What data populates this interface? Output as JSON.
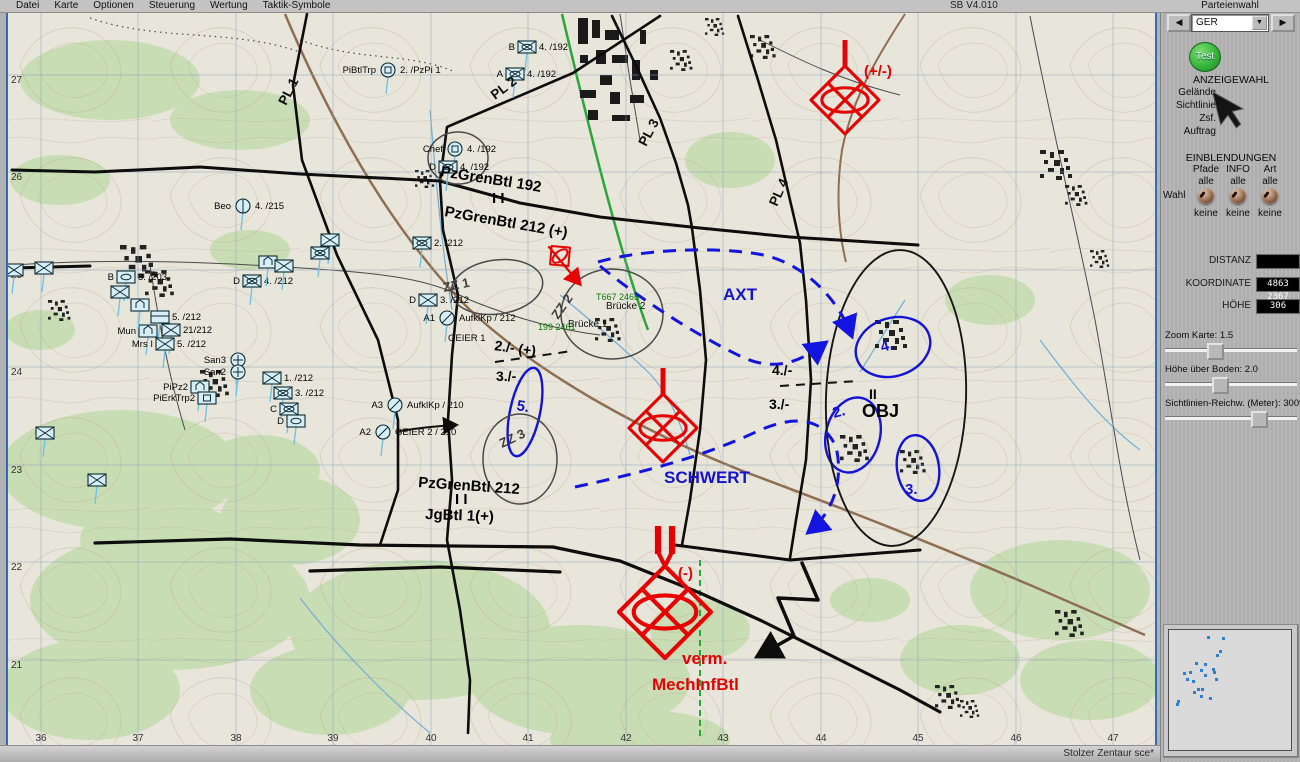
{
  "menu": {
    "items": [
      "Datei",
      "Karte",
      "Optionen",
      "Steuerung",
      "Wertung",
      "Taktik-Symbole"
    ],
    "version": "SB V4.010"
  },
  "panel": {
    "party_label": "Parteienwahl",
    "party_value": "GER",
    "left_arrow": "◀",
    "right_arrow": "▶",
    "dropdown_arrow": "▼",
    "test_button": "Test",
    "anzeigewahl": {
      "title": "ANZEIGEWAHL",
      "items": [
        "Gelände",
        "Sichtlinie",
        "Zsf.",
        "Auftrag"
      ]
    },
    "einblendungen": {
      "title": "EINBLENDUNGEN",
      "wahl_label": "Wahl",
      "columns": [
        {
          "name": "Pfade",
          "top": "alle",
          "bottom": "keine"
        },
        {
          "name": "INFO",
          "top": "alle",
          "bottom": "keine"
        },
        {
          "name": "Art",
          "top": "alle",
          "bottom": "keine"
        }
      ]
    },
    "readouts": [
      {
        "label": "DISTANZ",
        "value": ""
      },
      {
        "label": "KOORDINATE",
        "value": "4863 2367"
      },
      {
        "label": "HÖHE",
        "value": "306"
      }
    ],
    "sliders": [
      {
        "label": "Zoom Karte:  1.5",
        "pos": 36
      },
      {
        "label": "Höhe über Boden:  2.0",
        "pos": 40
      },
      {
        "label": "Sichtlinien-Reichw. (Meter):  3009",
        "pos": 70
      }
    ],
    "minimap_dots": [
      [
        0.32,
        0.05
      ],
      [
        0.44,
        0.06
      ],
      [
        0.42,
        0.17
      ],
      [
        0.39,
        0.2
      ],
      [
        0.22,
        0.27
      ],
      [
        0.29,
        0.28
      ],
      [
        0.36,
        0.32
      ],
      [
        0.26,
        0.33
      ],
      [
        0.17,
        0.35
      ],
      [
        0.12,
        0.36
      ],
      [
        0.37,
        0.35
      ],
      [
        0.29,
        0.37
      ],
      [
        0.14,
        0.41
      ],
      [
        0.19,
        0.42
      ],
      [
        0.38,
        0.41
      ],
      [
        0.23,
        0.49
      ],
      [
        0.27,
        0.49
      ],
      [
        0.2,
        0.52
      ],
      [
        0.26,
        0.55
      ],
      [
        0.33,
        0.57
      ],
      [
        0.07,
        0.59
      ],
      [
        0.06,
        0.62
      ]
    ]
  },
  "statusbar": {
    "text": "Stolzer Zentaur sce*"
  },
  "map": {
    "grid_x": [
      [
        "36",
        41
      ],
      [
        "37",
        138
      ],
      [
        "38",
        236
      ],
      [
        "39",
        333
      ],
      [
        "40",
        431
      ],
      [
        "41",
        528
      ],
      [
        "42",
        626
      ],
      [
        "43",
        723
      ],
      [
        "44",
        821
      ],
      [
        "45",
        918
      ],
      [
        "46",
        1016
      ],
      [
        "47",
        1113
      ]
    ],
    "grid_y": [
      [
        "27",
        79
      ],
      [
        "26",
        176
      ],
      [
        "25",
        274
      ],
      [
        "24",
        371
      ],
      [
        "23",
        469
      ],
      [
        "22",
        566
      ],
      [
        "21",
        664
      ]
    ],
    "labels": [
      [
        "PL 1",
        286,
        106,
        "pl",
        -63
      ],
      [
        "PL 2",
        495,
        100,
        "pl",
        -37
      ],
      [
        "PL 3",
        646,
        147,
        "pl",
        -62
      ],
      [
        "PL 4",
        777,
        207,
        "pl",
        -66
      ],
      [
        "PzGrenBtl 192",
        440,
        176,
        "bdy",
        9
      ],
      [
        "I I",
        492,
        203,
        "bdy",
        0
      ],
      [
        "PzGrenBtl 212 (+)",
        444,
        216,
        "bdy",
        10
      ],
      [
        "PzGrenBtl 212",
        418,
        487,
        "bdy",
        4
      ],
      [
        "I I",
        455,
        504,
        "bdy",
        0
      ],
      [
        "JgBtl 1(+)",
        425,
        519,
        "bdy",
        2
      ],
      [
        "AXT",
        723,
        300,
        "blue",
        0
      ],
      [
        "SCHWERT",
        664,
        483,
        "blue",
        0
      ],
      [
        "5.",
        516,
        410,
        "bnum",
        10
      ],
      [
        "4.",
        882,
        352,
        "bnum",
        -15
      ],
      [
        "2.",
        834,
        418,
        "bnum",
        -15
      ],
      [
        "3.",
        905,
        494,
        "bnum",
        0
      ],
      [
        "2./- (+)",
        494,
        350,
        "knum",
        8
      ],
      [
        "3./-",
        496,
        381,
        "knum",
        0
      ],
      [
        "4./-",
        772,
        375,
        "knum",
        0
      ],
      [
        "3./-",
        769,
        409,
        "knum",
        0
      ],
      [
        "II",
        869,
        399,
        "knum",
        0
      ],
      [
        "OBJ",
        862,
        417,
        "obj",
        0
      ],
      [
        "ZZ 1",
        444,
        292,
        "zz",
        -12
      ],
      [
        "ZZ 2",
        558,
        320,
        "zz",
        -55
      ],
      [
        "ZZ 3",
        502,
        448,
        "zz",
        -25
      ],
      [
        "(+/-)",
        864,
        76,
        "redl",
        0
      ],
      [
        "(-)",
        678,
        578,
        "redl",
        0
      ],
      [
        "verm.",
        682,
        664,
        "redbig",
        0
      ],
      [
        "MechInfBtl",
        652,
        690,
        "redbig",
        0
      ],
      [
        "Brücke 2",
        606,
        309,
        "place",
        0
      ],
      [
        "Brücke 1",
        568,
        327,
        "place",
        0
      ],
      [
        "T667 2465",
        596,
        300,
        "green",
        0
      ],
      [
        "199 2461",
        538,
        330,
        "green",
        0
      ],
      [
        "GEIER 1",
        448,
        341,
        "unit",
        0
      ]
    ],
    "units": [
      [
        527,
        47,
        "r",
        "xo",
        "B",
        "4. /192"
      ],
      [
        515,
        74,
        "r",
        "xo",
        "A",
        "4. /192"
      ],
      [
        455,
        149,
        "c",
        "sq",
        "Chef",
        "4. /192"
      ],
      [
        448,
        167,
        "r",
        "xo",
        "D",
        "4. /192"
      ],
      [
        388,
        70,
        "c",
        "sq",
        "PiBtlTrp",
        "2. /PzPi 1"
      ],
      [
        243,
        206,
        "c",
        "ln",
        "Beo",
        "4. /215"
      ],
      [
        126,
        277,
        "r",
        "o",
        "B",
        "3. /203"
      ],
      [
        14,
        270,
        "r",
        "x",
        "",
        ""
      ],
      [
        44,
        268,
        "r",
        "x",
        "",
        ""
      ],
      [
        160,
        317,
        "r",
        "ln",
        "",
        "5. /212"
      ],
      [
        148,
        331,
        "r",
        "house",
        "Mun",
        ""
      ],
      [
        171,
        330,
        "r",
        "x",
        "",
        "21/212"
      ],
      [
        165,
        344,
        "r",
        "x",
        "Mrs I",
        "5. /212"
      ],
      [
        238,
        360,
        "c",
        "cross",
        "San3",
        ""
      ],
      [
        238,
        372,
        "c",
        "cross",
        "San2",
        ""
      ],
      [
        200,
        387,
        "r",
        "house",
        "PiPz2",
        ""
      ],
      [
        207,
        398,
        "r",
        "sq",
        "PiErkTrp2",
        ""
      ],
      [
        252,
        281,
        "r",
        "xo",
        "D",
        "4. /212"
      ],
      [
        268,
        262,
        "r",
        "house",
        "",
        ""
      ],
      [
        284,
        266,
        "r",
        "x",
        "",
        ""
      ],
      [
        272,
        378,
        "r",
        "x",
        "",
        "1. /212"
      ],
      [
        283,
        393,
        "r",
        "xo",
        "",
        "3. /212"
      ],
      [
        289,
        409,
        "r",
        "xo",
        "C",
        ""
      ],
      [
        296,
        421,
        "r",
        "o",
        "D",
        ""
      ],
      [
        422,
        243,
        "r",
        "xo",
        "",
        "2. /212"
      ],
      [
        428,
        300,
        "r",
        "x",
        "D",
        "3. /212"
      ],
      [
        447,
        318,
        "c",
        "slash",
        "A1",
        "AufklKp / 212"
      ],
      [
        395,
        405,
        "c",
        "slash",
        "A3",
        "AufklKp / 210"
      ],
      [
        383,
        432,
        "c",
        "slash",
        "A2",
        "GEIER 2 / 210"
      ],
      [
        45,
        433,
        "r",
        "x",
        "",
        ""
      ],
      [
        97,
        480,
        "r",
        "x",
        "",
        ""
      ],
      [
        120,
        292,
        "r",
        "x",
        "",
        ""
      ],
      [
        140,
        305,
        "r",
        "house",
        "",
        ""
      ],
      [
        330,
        240,
        "r",
        "x",
        "",
        ""
      ],
      [
        320,
        253,
        "r",
        "xo",
        "",
        ""
      ]
    ],
    "red_units": [
      {
        "x": 845,
        "y": 100,
        "h": 34,
        "st": 1,
        "xx": 1,
        "rot": 0
      },
      {
        "x": 663,
        "y": 428,
        "h": 34,
        "st": 1,
        "xx": 1,
        "rot": 0
      },
      {
        "x": 665,
        "y": 612,
        "h": 46,
        "st": 2,
        "xx": 1,
        "rot": 0
      },
      {
        "x": 560,
        "y": 256,
        "h": 13,
        "st": 0,
        "xx": 0,
        "rot": -40
      }
    ],
    "ellipses": [
      [
        893,
        347,
        38,
        29,
        -18,
        "eb"
      ],
      [
        853,
        435,
        27,
        38,
        14,
        "eb"
      ],
      [
        918,
        468,
        21,
        33,
        -8,
        "eb"
      ],
      [
        525,
        412,
        15,
        45,
        12,
        "eb"
      ],
      [
        497,
        287,
        46,
        27,
        -8,
        "eg"
      ],
      [
        612,
        314,
        51,
        45,
        0,
        "eg"
      ],
      [
        520,
        459,
        37,
        45,
        0,
        "eg"
      ],
      [
        458,
        158,
        30,
        26,
        0,
        "eg"
      ],
      [
        896,
        398,
        70,
        148,
        2,
        "ek"
      ]
    ],
    "axes": [
      "M598,262 C640,250 710,246 758,254 C805,262 838,300 851,334",
      "M600,266 C635,295 690,332 742,357 C775,372 800,362 824,344",
      "M575,487 C640,473 700,458 758,431 C798,413 824,420 836,447 C844,480 833,512 810,531"
    ],
    "lines": [
      [
        "M12,170 L95,172 L200,167 L300,174 L440,181",
        3
      ],
      [
        "M440,181 L520,203 L600,217 L700,228 L790,237 L918,245",
        3
      ],
      [
        "M307,14 L293,85 L302,160 L337,255 L378,340 L398,420 L398,490 L380,545",
        2.6
      ],
      [
        "M660,16 L573,73 L447,127 L440,181",
        2.6
      ],
      [
        "M440,181 L443,230 L458,295 L452,355 L448,420 L452,480 L447,540 L460,610 L470,680 L468,733",
        2.6
      ],
      [
        "M612,16 L638,70 L660,118 L676,163 L688,205 L692,228",
        2.6
      ],
      [
        "M692,228 L700,290 L706,360 L700,430 L690,500 L682,545",
        2.6
      ],
      [
        "M738,16 L758,80 L776,140 L790,200 L800,243",
        2.6
      ],
      [
        "M800,243 L806,300 L811,380 L806,460 L796,520 L790,558",
        2.6
      ],
      [
        "M95,543 L230,539 L360,545 L553,547",
        3.2
      ],
      [
        "M310,571 L440,567 L560,572",
        3.2
      ],
      [
        "M553,547 L620,561 L700,593 L762,621 L830,655 L900,690 L940,712",
        3.2
      ],
      [
        "M675,545 L790,560 L920,550",
        3
      ],
      [
        "M12,268 L90,266",
        3
      ]
    ],
    "dashes": [
      "M495,362 L572,351",
      "M780,386 L858,381"
    ],
    "black_arrows": [
      [
        "M400,431 C425,427 438,426 455,425",
        2
      ],
      [
        "M802,563 L818,600 L778,598 L794,636 L760,655",
        3.5
      ]
    ],
    "red_arrow": "M549,247 L579,283"
  }
}
